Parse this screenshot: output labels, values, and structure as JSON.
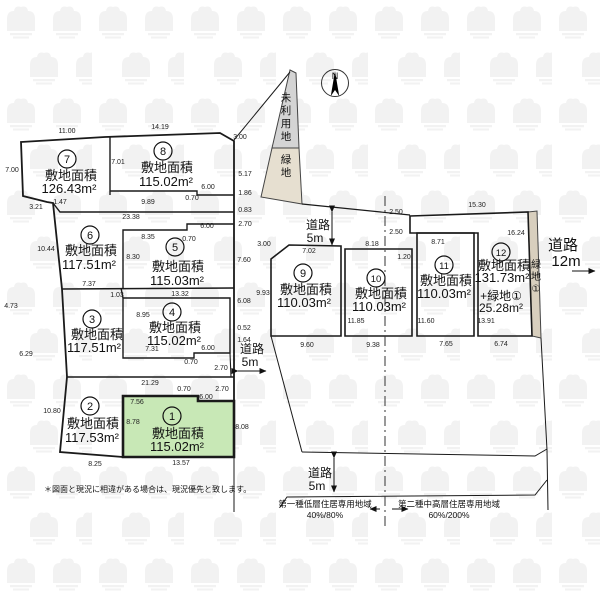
{
  "note": "＊図面と現況に相違がある場合は、現況優先と致します。",
  "north_label": "N",
  "lots": [
    {
      "n": "1",
      "label": "敷地面積",
      "area": "115.02m²"
    },
    {
      "n": "2",
      "label": "敷地面積",
      "area": "117.53m²"
    },
    {
      "n": "3",
      "label": "敷地面積",
      "area": "117.51m²"
    },
    {
      "n": "4",
      "label": "敷地面積",
      "area": "115.02m²"
    },
    {
      "n": "5",
      "label": "敷地面積",
      "area": "115.03m²"
    },
    {
      "n": "6",
      "label": "敷地面積",
      "area": "117.51m²"
    },
    {
      "n": "7",
      "label": "敷地面積",
      "area": "126.43m²"
    },
    {
      "n": "8",
      "label": "敷地面積",
      "area": "115.02m²"
    },
    {
      "n": "9",
      "label": "敷地面積",
      "area": "110.03m²"
    },
    {
      "n": "10",
      "label": "敷地面積",
      "area": "110.03m²"
    },
    {
      "n": "11",
      "label": "敷地面積",
      "area": "110.03m²"
    },
    {
      "n": "12",
      "label": "敷地面積",
      "area": "131.73m²",
      "extra": "+緑地①",
      "extra_area": "25.28m²"
    }
  ],
  "land_labels": {
    "unused": "未利用地",
    "green": "緑地",
    "green_right": "緑地①"
  },
  "roads": {
    "ns": {
      "name": "道路",
      "width": "5m"
    },
    "top": {
      "name": "道路",
      "width": "5m"
    },
    "bottom": {
      "name": "道路",
      "width": "5m"
    },
    "east": {
      "name": "道路",
      "width": "12m"
    }
  },
  "zoning": {
    "left": {
      "name": "第一種低層住居専用地域",
      "ratio": "40%/80%"
    },
    "right": {
      "name": "第二種中高層住居専用地域",
      "ratio": "60%/200%"
    }
  },
  "colors": {
    "highlight_lot": "#c8e8b6",
    "unused_strip": "#d4d4d4",
    "green_strip": "#e6dfd0",
    "green_right_strip": "#d8cfbe",
    "line": "#1a1a1a"
  },
  "dims": [
    "11.00",
    "14.19",
    "3.00",
    "7.00",
    "7.01",
    "5.17",
    "6.00",
    "0.70",
    "9.89",
    "1.86",
    "3.21",
    "1.47",
    "23.38",
    "0.83",
    "2.70",
    "8.35",
    "0.70",
    "6.00",
    "10.44",
    "8.30",
    "7.60",
    "7.37",
    "1.03",
    "13.32",
    "6.08",
    "9.93",
    "8.95",
    "0.52",
    "1.64",
    "7.31",
    "6.00",
    "0.70",
    "2.70",
    "4.73",
    "6.29",
    "21.29",
    "0.70",
    "2.70",
    "7.56",
    "6.00",
    "10.80",
    "8.78",
    "8.08",
    "8.25",
    "13.57",
    "3.00",
    "7.02",
    "8.18",
    "2.50",
    "2.50",
    "1.20",
    "8.71",
    "15.30",
    "16.24",
    "11.85",
    "11.60",
    "13.91",
    "9.60",
    "9.38",
    "7.65",
    "6.74"
  ]
}
